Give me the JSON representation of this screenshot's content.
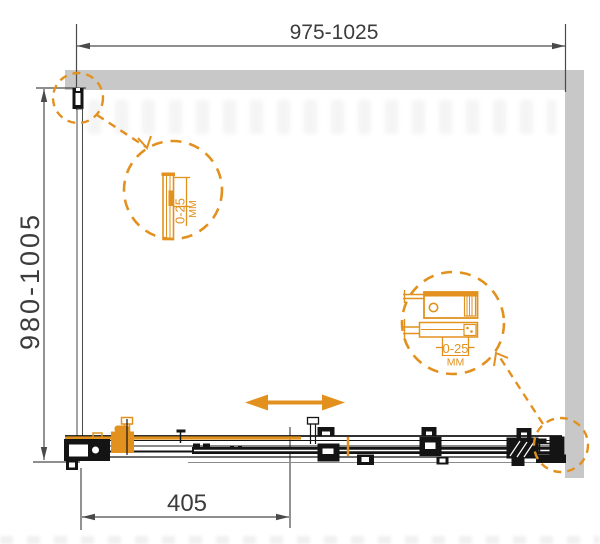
{
  "dimensions": {
    "top_width": "975-1025",
    "side_depth": "980-1005",
    "door_width": "405"
  },
  "details": {
    "wall_profile": {
      "adjustment": "0-25",
      "unit": "ММ"
    },
    "door_mechanism": {
      "adjustment": "0-25",
      "unit": "ММ"
    }
  },
  "colors": {
    "accent_orange": "#e2911f",
    "wall_gray": "#c8c8c8",
    "line_black": "#141414",
    "dim_gray": "#4a4a4a"
  }
}
